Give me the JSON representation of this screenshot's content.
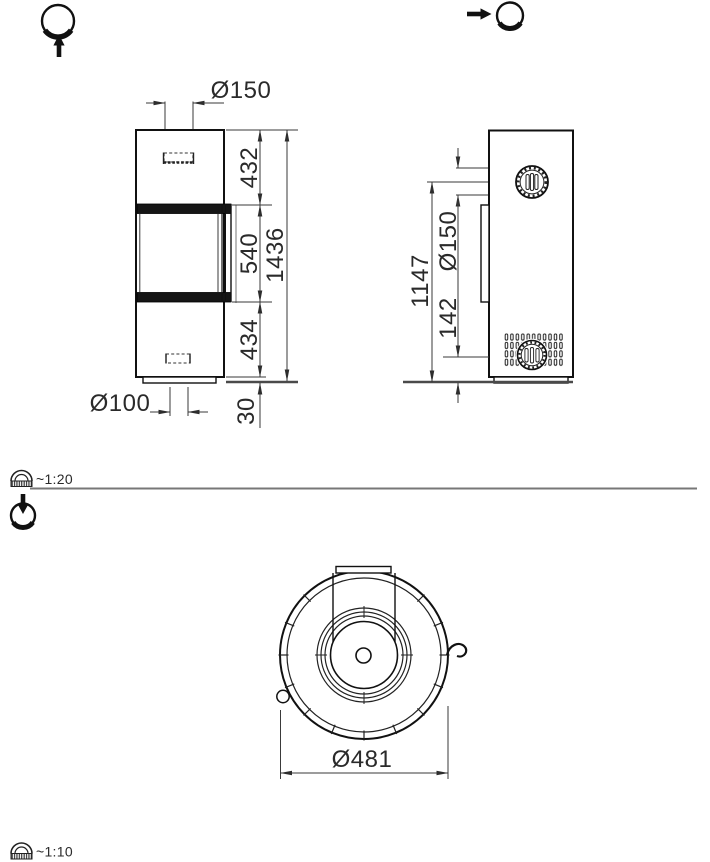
{
  "front_view": {
    "flue_diameter": "Ø150",
    "height_top_section": "432",
    "height_window": "540",
    "height_bottom_section": "434",
    "height_total": "1436",
    "inlet_diameter": "Ø100",
    "plinth_height": "30"
  },
  "side_view": {
    "flue_diameter": "Ø150",
    "height_flue_center": "1147",
    "height_vent_center": "142"
  },
  "top_view": {
    "body_diameter": "Ø481"
  },
  "scale_upper": {
    "label": "~1:20"
  },
  "scale_lower": {
    "label": "~1:10"
  },
  "icons": {
    "front_view_indicator": "stove-circle-with-up-arrow-icon",
    "side_view_indicator": "arrow-right-to-circle-icon",
    "top_view_indicator": "arrow-down-into-circle-icon",
    "scale_upper_icon": "protractor-ruler-icon",
    "scale_lower_icon": "protractor-ruler-icon"
  }
}
